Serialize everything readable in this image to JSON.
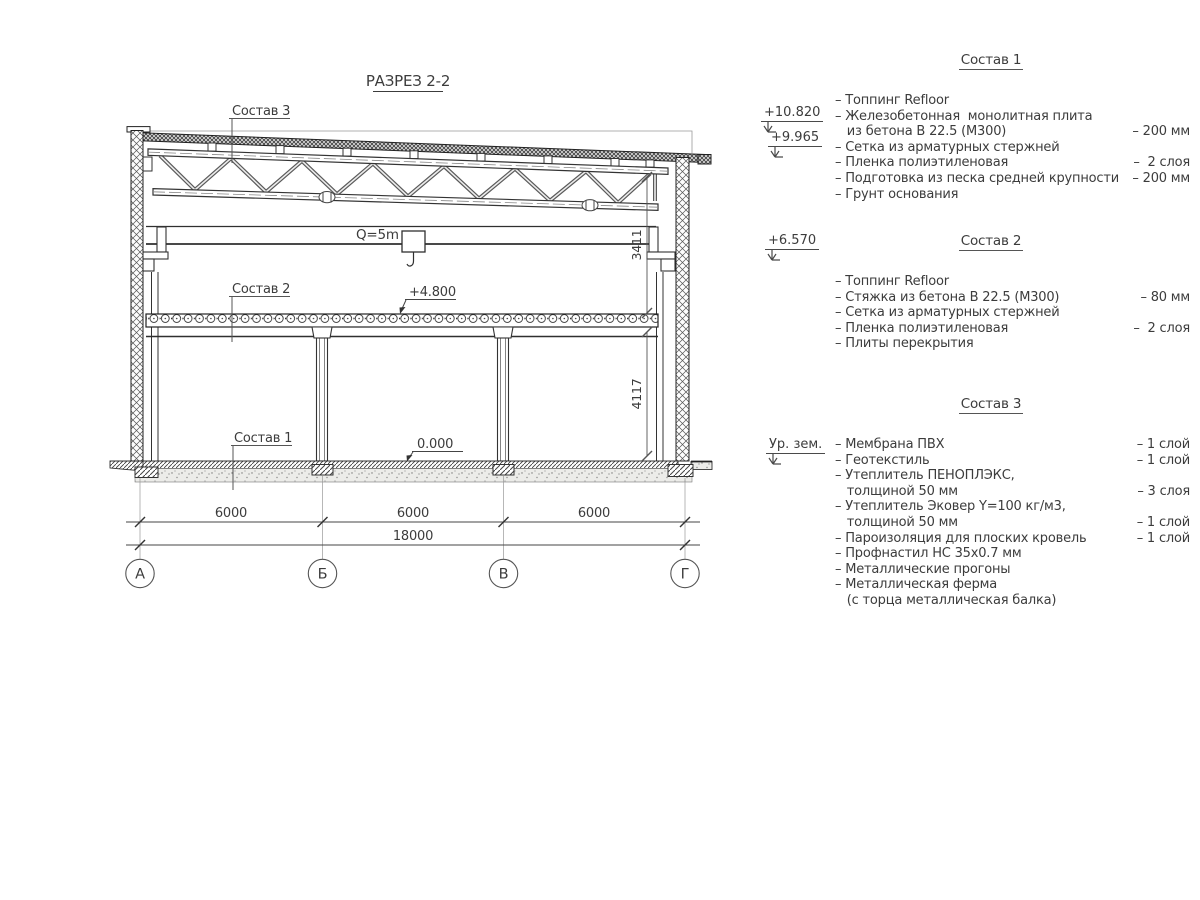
{
  "drawing": {
    "title": "РАЗРЕЗ 2-2",
    "crane_label": "Q=5m",
    "labels": {
      "sostav1": "Состав 1",
      "sostav2": "Состав 2",
      "sostav3": "Состав 3"
    },
    "levels": {
      "slab": "+4.800",
      "floor": "0.000"
    },
    "dims": {
      "bays": [
        "6000",
        "6000",
        "6000"
      ],
      "total": "18000",
      "v_upper": "3411",
      "v_lower": "4117"
    },
    "axes": [
      "А",
      "Б",
      "В",
      "Г"
    ]
  },
  "marks": [
    {
      "label": "+10.820"
    },
    {
      "label": "+9.965"
    },
    {
      "label": "+6.570"
    },
    {
      "label": "Ур. зем."
    }
  ],
  "specs": [
    {
      "title": "Состав 1",
      "rows": [
        {
          "t": "– Топпинг Refloor",
          "v": ""
        },
        {
          "t": "– Железобетонная  монолитная плита",
          "v": ""
        },
        {
          "t": "   из бетона В 22.5 (М300)",
          "v": "– 200 мм"
        },
        {
          "t": "– Сетка из арматурных стержней",
          "v": ""
        },
        {
          "t": "– Пленка полиэтиленовая",
          "v": "–  2 слоя"
        },
        {
          "t": "– Подготовка из песка средней крупности",
          "v": "– 200 мм"
        },
        {
          "t": "– Грунт основания",
          "v": ""
        }
      ]
    },
    {
      "title": "Состав 2",
      "rows": [
        {
          "t": "– Топпинг Refloor",
          "v": ""
        },
        {
          "t": "– Стяжка из бетона В 22.5 (М300)",
          "v": "– 80 мм"
        },
        {
          "t": "– Сетка из арматурных стержней",
          "v": ""
        },
        {
          "t": "– Пленка полиэтиленовая",
          "v": "–  2 слоя"
        },
        {
          "t": "– Плиты перекрытия",
          "v": ""
        }
      ]
    },
    {
      "title": "Состав 3",
      "rows": [
        {
          "t": "– Мембрана ПВХ",
          "v": "– 1 слой"
        },
        {
          "t": "– Геотекстиль",
          "v": "– 1 слой"
        },
        {
          "t": "– Утеплитель ПЕНОПЛЭКС,",
          "v": ""
        },
        {
          "t": "   толщиной 50 мм",
          "v": "– 3 слоя"
        },
        {
          "t": "– Утеплитель Эковер Y=100 кг/м3,",
          "v": ""
        },
        {
          "t": "   толщиной 50 мм",
          "v": "– 1 слой"
        },
        {
          "t": "– Пароизоляция для плоских кровель",
          "v": "– 1 слой"
        },
        {
          "t": "– Профнастил НС 35х0.7 мм",
          "v": ""
        },
        {
          "t": "– Металлические прогоны",
          "v": ""
        },
        {
          "t": "– Металлическая ферма",
          "v": ""
        },
        {
          "t": "   (с торца металлическая балка)",
          "v": ""
        }
      ]
    }
  ],
  "colors": {
    "line": "#2f2f2f",
    "text": "#3c3c3c",
    "hatch": "#555555"
  }
}
